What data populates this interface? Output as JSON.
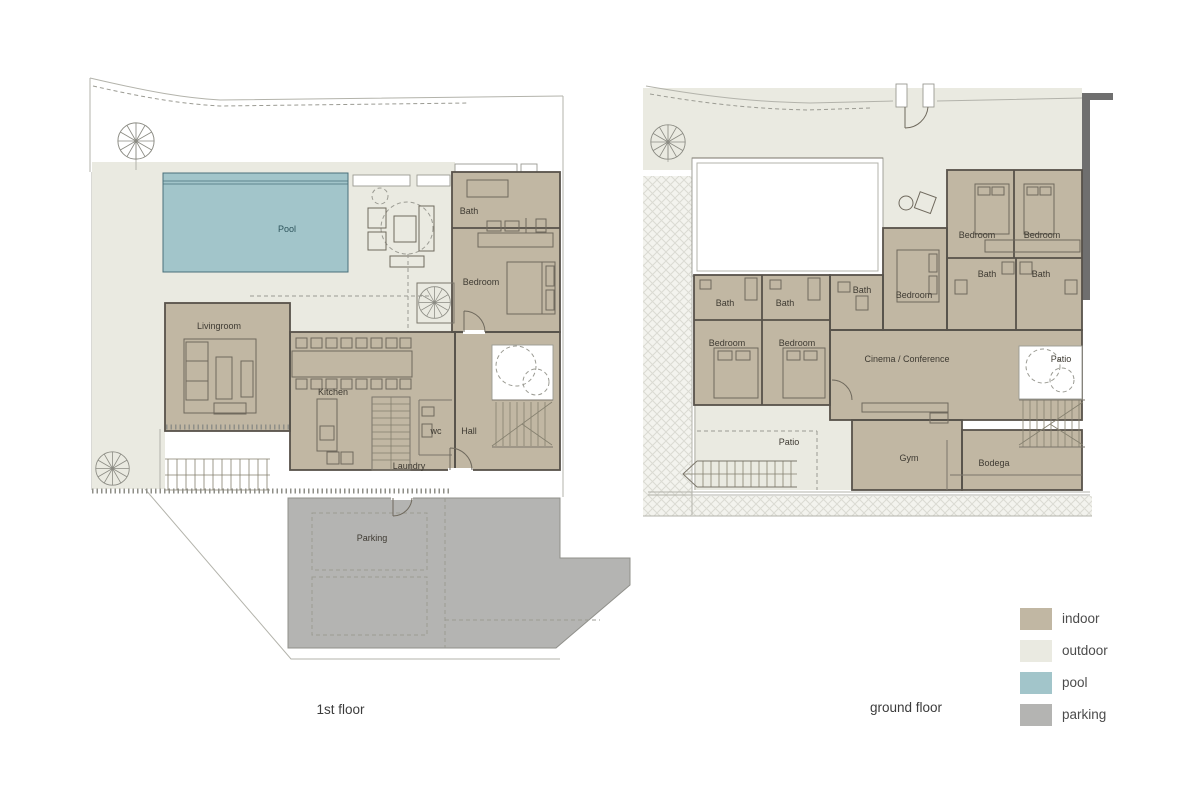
{
  "colors": {
    "indoor": "#c1b7a3",
    "outdoor": "#eaeae1",
    "pool": "#a2c5ca",
    "parking": "#b4b4b2",
    "wall": "#57524a",
    "wall_dark": "#6f6f6f",
    "label": "#3e3a32",
    "pool_label": "#2d545c"
  },
  "plans": {
    "first_floor": {
      "title": "1st floor",
      "rooms": {
        "pool": "Pool",
        "livingroom": "Livingroom",
        "kitchen": "Kitchen",
        "bath": "Bath",
        "bedroom": "Bedroom",
        "wc": "wc",
        "hall": "Hall",
        "laundry": "Laundry",
        "parking": "Parking"
      }
    },
    "ground_floor": {
      "title": "ground floor",
      "rooms": {
        "bath_left_1": "Bath",
        "bath_left_2": "Bath",
        "bath_mid": "Bath",
        "bedroom_left_1": "Bedroom",
        "bedroom_left_2": "Bedroom",
        "bedroom_mid": "Bedroom",
        "bedroom_right_1": "Bedroom",
        "bedroom_right_2": "Bedroom",
        "bath_right_1": "Bath",
        "bath_right_2": "Bath",
        "cinema": "Cinema / Conference",
        "patio_left": "Patio",
        "patio_right": "Patio",
        "gym": "Gym",
        "bodega": "Bodega"
      }
    }
  },
  "legend": {
    "items": [
      {
        "key": "indoor",
        "label": "indoor"
      },
      {
        "key": "outdoor",
        "label": "outdoor"
      },
      {
        "key": "pool",
        "label": "pool"
      },
      {
        "key": "parking",
        "label": "parking"
      }
    ]
  }
}
